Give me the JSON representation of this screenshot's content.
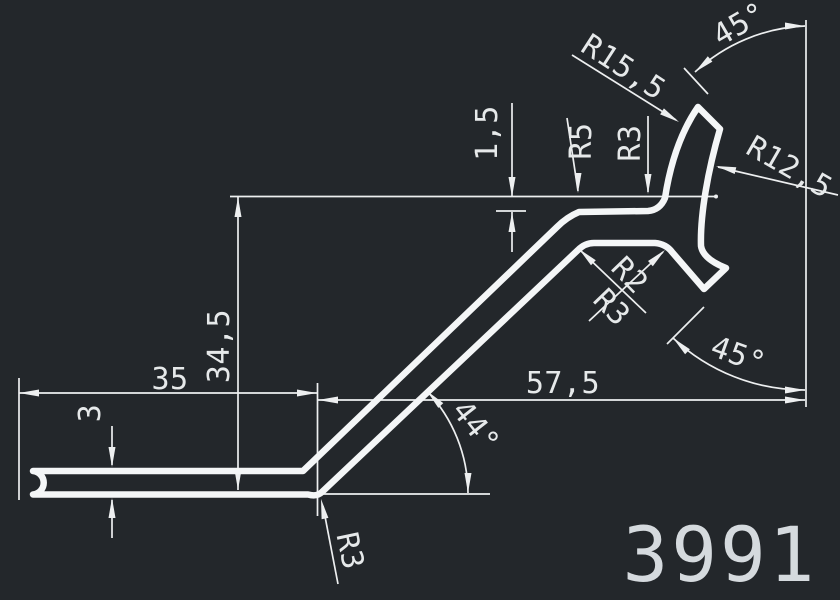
{
  "drawing": {
    "part_number": "3991",
    "background_color": "#23272b",
    "line_color": "#f4f6f7",
    "dim_color": "#edeff0",
    "dimensions": {
      "top_angle": "45°",
      "hook_outer_radius": "R15,5",
      "hook_inner_radius": "R12,5",
      "top_offset": "1,5",
      "left_top_fillet": "R5",
      "right_top_fillet": "R3",
      "overall_height": "34,5",
      "base_length": "35",
      "wall_thickness": "3",
      "notch_fillet_small": "R2",
      "notch_fillet_large": "R3",
      "diagonal_span": "57,5",
      "strut_angle": "44°",
      "lower_leg_angle": "45°",
      "bend_radius": "R3"
    }
  }
}
